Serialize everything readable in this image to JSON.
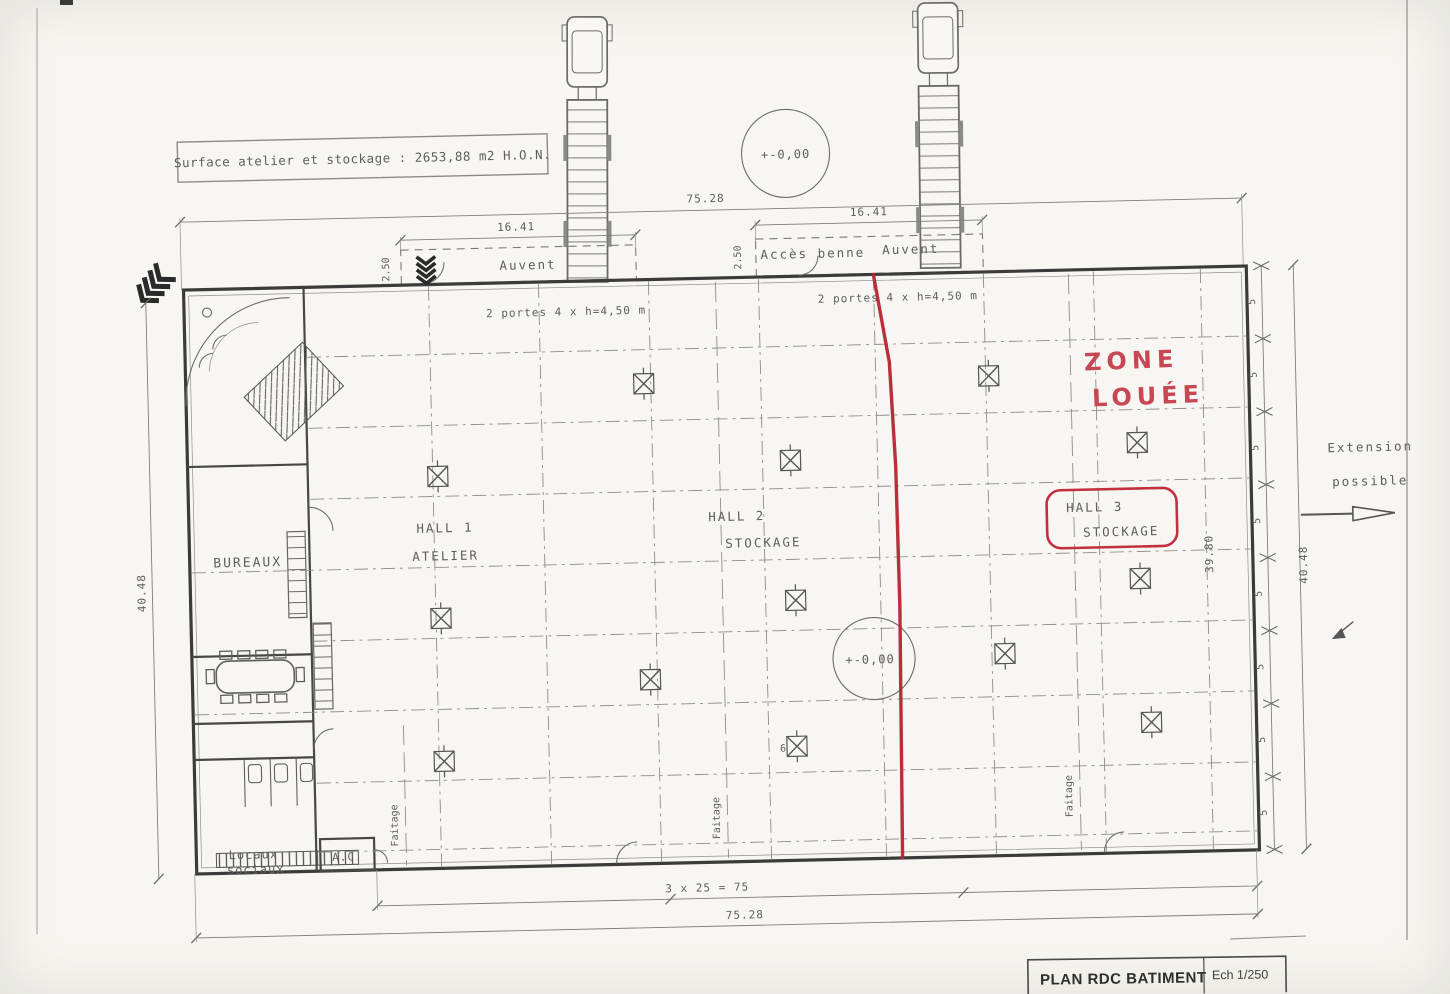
{
  "drawing": {
    "surface_note": "Surface atelier et stockage : 2653,88 m2 H.O.N.",
    "title_block": {
      "title": "PLAN RDC BATIMENT",
      "scale": "Ech 1/250"
    },
    "zone": {
      "line1": "ZONE",
      "line2": "LOUÉE"
    },
    "extension": {
      "line1": "Extension",
      "line2": "possible"
    },
    "halls": {
      "hall1": {
        "line1": "HALL 1",
        "line2": "ATELIER"
      },
      "hall2": {
        "line1": "HALL 2",
        "line2": "STOCKAGE"
      },
      "hall3": {
        "line1": "HALL 3",
        "line2": "STOCKAGE"
      }
    },
    "rooms": {
      "bureaux": "BUREAUX",
      "locaux1": "Locaux",
      "locaux2": "sociaux",
      "ac": "A.C."
    },
    "canopy": {
      "auvent_left": "Auvent",
      "acces_benne": "Accès benne",
      "auvent_right": "Auvent",
      "doors_left": "2 portes 4 x h=4,50 m",
      "doors_right": "2 portes 4 x h=4,50 m"
    },
    "levels": {
      "top": "+-0,00",
      "middle": "+-0,00"
    },
    "dims": {
      "top_overall": "75.28",
      "bay_left": "16.41",
      "bay_right": "16.41",
      "canopy_left": "2.50",
      "canopy_right": "2.50",
      "height_left": "40.48",
      "height_right": "40.48",
      "height_inner": "39.80",
      "bottom_bays": "3 x 25 = 75",
      "bottom_overall": "75.28",
      "module": "5",
      "column_note": "6"
    },
    "faitage": "Faitage",
    "colors": {
      "red_line": "#b5252f",
      "red_hand": "#c84754",
      "ink": "#5e5e5e",
      "wall": "#3b3b3b"
    }
  }
}
